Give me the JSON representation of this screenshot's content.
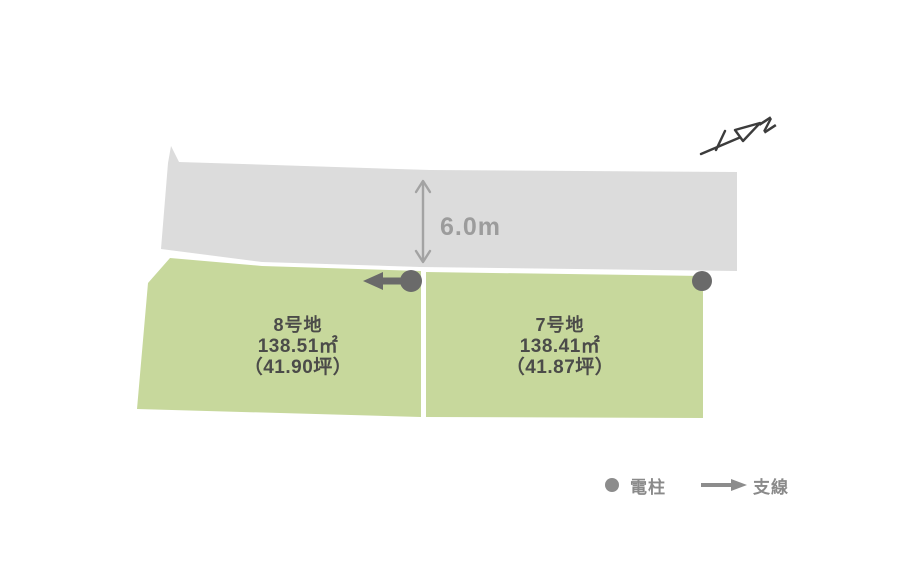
{
  "diagram_type": "land-lot-layout",
  "colors": {
    "background": "#ffffff",
    "road": "#dcdcdc",
    "plot": "#c7d89c",
    "plot_text": "#4b4b49",
    "dimension": "#a3a3a3",
    "pole": "#6a6a6a",
    "legend": "#8c8c8c",
    "north": "#3c3c3c"
  },
  "road": {
    "width_label": "6.0m"
  },
  "plots": [
    {
      "name": "8号地",
      "area_m2": "138.51㎡",
      "area_tsubo": "（41.90坪）"
    },
    {
      "name": "7号地",
      "area_m2": "138.41㎡",
      "area_tsubo": "（41.87坪）"
    }
  ],
  "north": {
    "label": "N"
  },
  "legend": {
    "pole_label": "電柱",
    "guy_wire_label": "支線"
  }
}
